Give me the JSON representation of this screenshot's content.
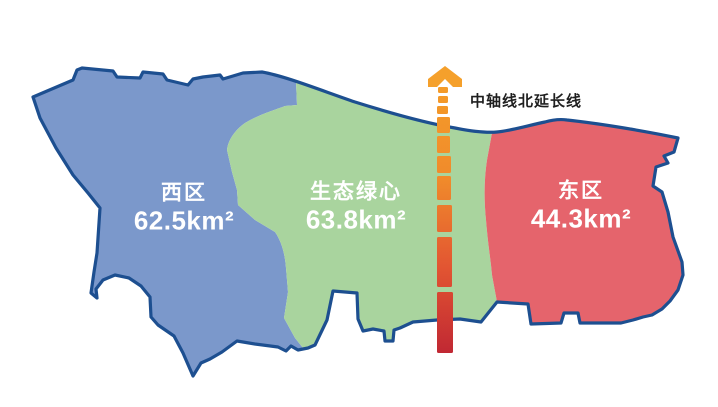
{
  "map": {
    "outline_color": "#1d4f90",
    "background_color": "#ffffff",
    "label_text_color": "#ffffff"
  },
  "regions": {
    "west": {
      "name": "西区",
      "area": "62.5km²",
      "color": "#7b98cb"
    },
    "center": {
      "name": "生态绿心",
      "area": "63.8km²",
      "color": "#a9d49e"
    },
    "east": {
      "name": "东区",
      "area": "44.3km²",
      "color": "#e5646c"
    }
  },
  "axis": {
    "label": "中轴线北延长线",
    "label_color": "#1f1f1f",
    "arrow_color": "#f5a02b",
    "gradient_top": "#f5a02a",
    "gradient_upper_mid": "#f08a2b",
    "gradient_lower_mid": "#e25532",
    "gradient_bottom": "#c02733"
  }
}
